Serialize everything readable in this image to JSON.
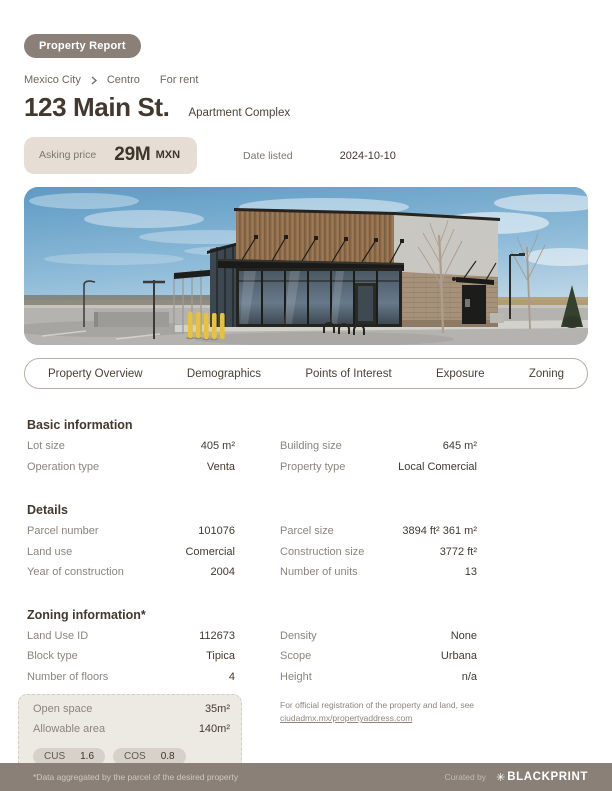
{
  "badge": {
    "label": "Property Report"
  },
  "breadcrumb": {
    "city": "Mexico City",
    "district": "Centro",
    "listing_type": "For rent"
  },
  "header": {
    "title": "123 Main St.",
    "subtitle": "Apartment Complex"
  },
  "pricing": {
    "label": "Asking price",
    "value": "29M",
    "currency": "MXN"
  },
  "listing": {
    "date_label": "Date listed",
    "date_value": "2024-10-10"
  },
  "photo": {
    "description": "Single-story commercial building with wood-clad parapet, black awning, glass storefront, yellow bollards and parking lot under a blue sky"
  },
  "tabs": {
    "items": [
      {
        "label": "Property Overview"
      },
      {
        "label": "Demographics"
      },
      {
        "label": "Points of Interest"
      },
      {
        "label": "Exposure"
      },
      {
        "label": "Zoning"
      }
    ]
  },
  "basic_info": {
    "heading": "Basic information",
    "left": [
      {
        "label": "Lot size",
        "value": "405 m²"
      },
      {
        "label": "Operation type",
        "value": "Venta"
      }
    ],
    "right": [
      {
        "label": "Building size",
        "value": "645 m²"
      },
      {
        "label": "Property type",
        "value": "Local Comercial"
      }
    ]
  },
  "details": {
    "heading": "Details",
    "left": [
      {
        "label": "Parcel number",
        "value": "101076"
      },
      {
        "label": "Land use",
        "value": "Comercial"
      },
      {
        "label": "Year of construction",
        "value": "2004"
      }
    ],
    "right": [
      {
        "label": "Parcel size",
        "value": "3894 ft² 361 m²"
      },
      {
        "label": "Construction size",
        "value": "3772 ft²"
      },
      {
        "label": "Number of units",
        "value": "13"
      }
    ]
  },
  "zoning": {
    "heading": "Zoning information*",
    "left": [
      {
        "label": "Land Use ID",
        "value": "112673"
      },
      {
        "label": "Block type",
        "value": "Tipica"
      },
      {
        "label": "Number of floors",
        "value": "4"
      }
    ],
    "right": [
      {
        "label": "Density",
        "value": "None"
      },
      {
        "label": "Scope",
        "value": "Urbana"
      },
      {
        "label": "Height",
        "value": "n/a"
      }
    ],
    "highlight": {
      "rows": [
        {
          "label": "Open space",
          "value": "35m²"
        },
        {
          "label": "Allowable area",
          "value": "140m²"
        }
      ],
      "pills": [
        {
          "label": "CUS",
          "value": "1.6"
        },
        {
          "label": "COS",
          "value": "0.8"
        }
      ]
    },
    "note": {
      "text": "For official registration of the property and land, see",
      "link": "ciudadmx.mx/propertyaddress.com"
    }
  },
  "footer": {
    "disclaimer": "*Data aggregated by the parcel of the desired property",
    "curated_label": "Curated by",
    "brand_icon": "✳",
    "brand": "BLACKPRINT"
  },
  "colors": {
    "accent_taupe": "#8a8078",
    "price_box_bg": "#e6ded4",
    "highlight_bg": "#edeae4",
    "pill_bg": "#d6d2c9",
    "text_dark": "#42392f",
    "text_muted": "#8b857d"
  }
}
